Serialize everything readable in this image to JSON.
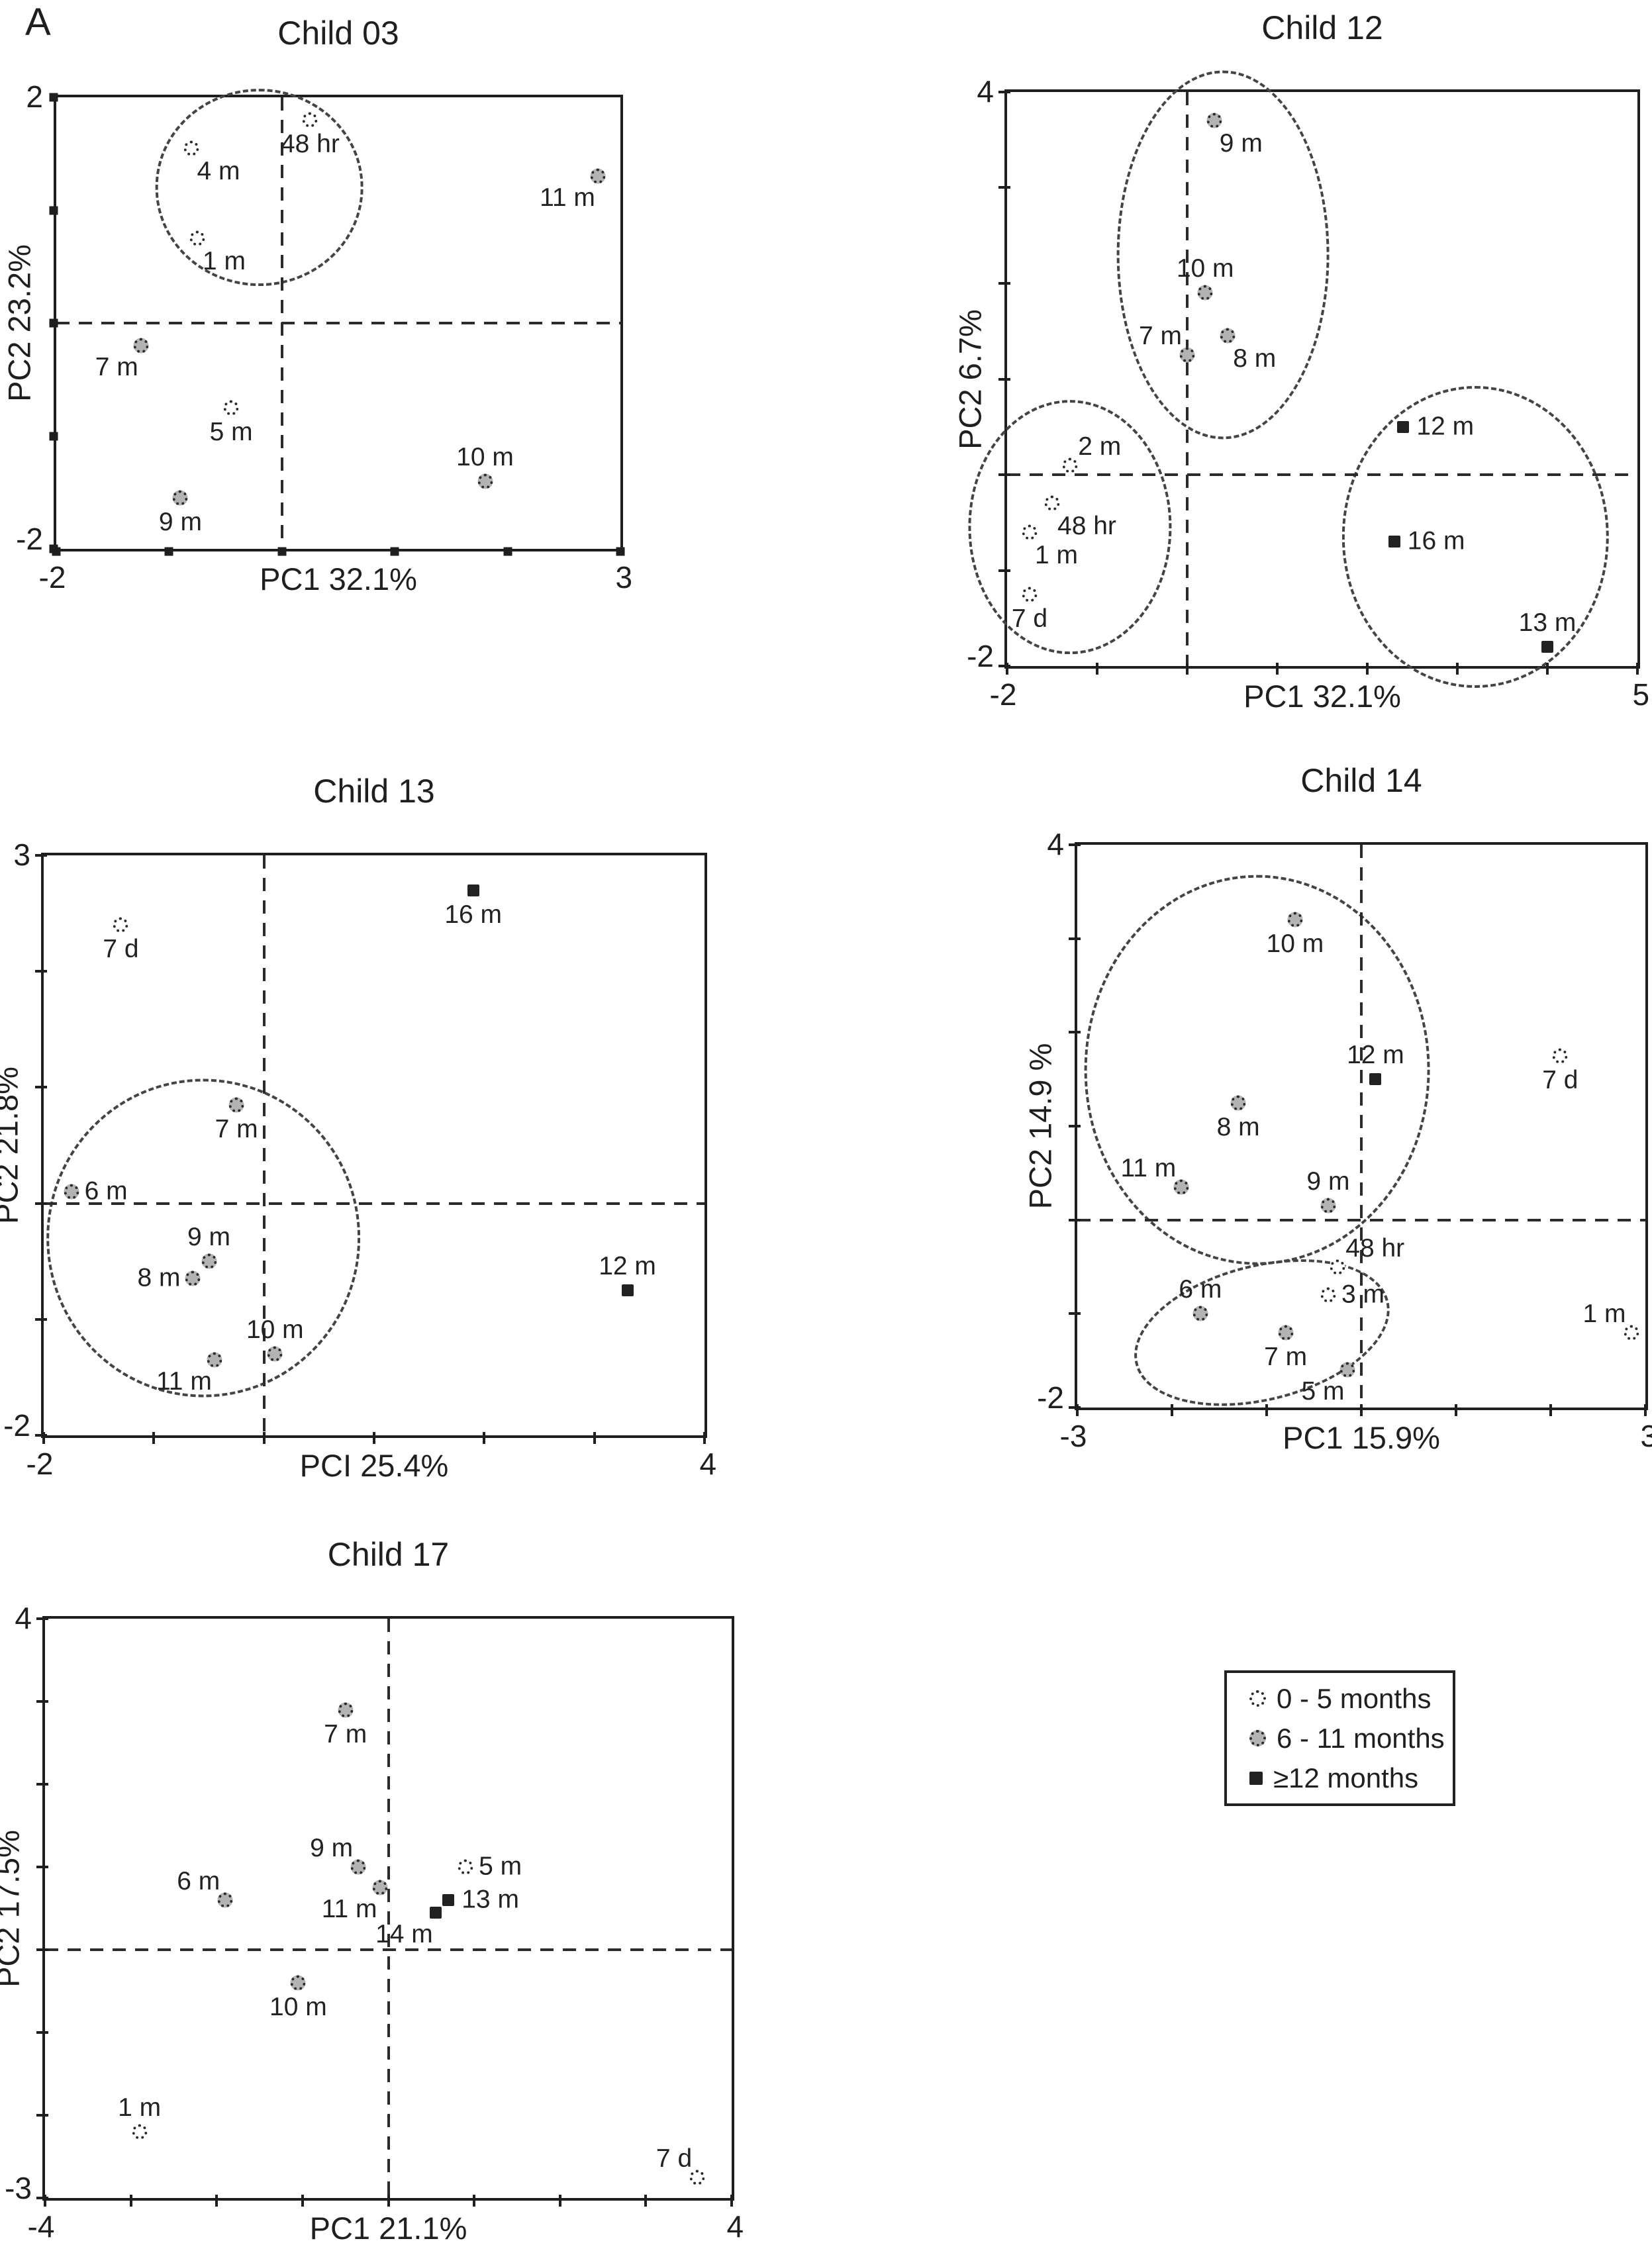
{
  "figure": {
    "panel_label": "A"
  },
  "legend": {
    "items": [
      {
        "marker": "open",
        "label": "0 - 5 months"
      },
      {
        "marker": "gray",
        "label": "6 - 11 months"
      },
      {
        "marker": "square",
        "label": "≥12 months"
      }
    ]
  },
  "chart_data": [
    {
      "type": "scatter",
      "title": "Child 03",
      "xlabel": "PC1 32.1%",
      "ylabel": "PC2 23.2%",
      "xlim": [
        -2,
        3
      ],
      "ylim": [
        -2,
        2
      ],
      "xticks": {
        "left": "-2",
        "right": "3"
      },
      "yticks": {
        "top": "2",
        "bottom": "-2"
      },
      "crosshair": {
        "x": 0,
        "y": 0
      },
      "tick_style": "square",
      "grid": false,
      "points": [
        {
          "label": "48 hr",
          "marker": "open",
          "x": 0.25,
          "y": 1.8,
          "label_pos": "below"
        },
        {
          "label": "4 m",
          "marker": "open",
          "x": -0.8,
          "y": 1.55,
          "label_pos": "below-right"
        },
        {
          "label": "1 m",
          "marker": "open",
          "x": -0.75,
          "y": 0.75,
          "label_pos": "below-right"
        },
        {
          "label": "11 m",
          "marker": "gray",
          "x": 2.8,
          "y": 1.3,
          "label_pos": "below-left"
        },
        {
          "label": "7 m",
          "marker": "gray",
          "x": -1.25,
          "y": -0.2,
          "label_pos": "below-left"
        },
        {
          "label": "5 m",
          "marker": "open",
          "x": -0.45,
          "y": -0.75,
          "label_pos": "below"
        },
        {
          "label": "9 m",
          "marker": "gray",
          "x": -0.9,
          "y": -1.55,
          "label_pos": "below"
        },
        {
          "label": "10 m",
          "marker": "gray",
          "x": 1.8,
          "y": -1.4,
          "label_pos": "above"
        }
      ],
      "ellipses": [
        {
          "cx": -0.2,
          "cy": 1.2,
          "rx": 0.9,
          "ry": 0.85,
          "rotate": 0
        }
      ]
    },
    {
      "type": "scatter",
      "title": "Child 12",
      "xlabel": "PC1 32.1%",
      "ylabel": "PC2 6.7%",
      "xlim": [
        -2,
        5
      ],
      "ylim": [
        -2,
        4
      ],
      "xticks": {
        "left": "-2",
        "right": "5"
      },
      "yticks": {
        "top": "4",
        "bottom": "-2"
      },
      "crosshair": {
        "x": 0,
        "y": 0
      },
      "tick_style": "line",
      "grid": false,
      "points": [
        {
          "label": "9 m",
          "marker": "gray",
          "x": 0.3,
          "y": 3.7,
          "label_pos": "below-right"
        },
        {
          "label": "10 m",
          "marker": "gray",
          "x": 0.2,
          "y": 1.9,
          "label_pos": "above"
        },
        {
          "label": "8 m",
          "marker": "gray",
          "x": 0.45,
          "y": 1.45,
          "label_pos": "below-right"
        },
        {
          "label": "7 m",
          "marker": "gray",
          "x": 0.0,
          "y": 1.25,
          "label_pos": "above-left"
        },
        {
          "label": "2 m",
          "marker": "open",
          "x": -1.3,
          "y": 0.1,
          "label_pos": "above-right"
        },
        {
          "label": "48 hr",
          "marker": "open",
          "x": -1.5,
          "y": -0.3,
          "label_pos": "below-right"
        },
        {
          "label": "1 m",
          "marker": "open",
          "x": -1.75,
          "y": -0.6,
          "label_pos": "below-right"
        },
        {
          "label": "7 d",
          "marker": "open",
          "x": -1.75,
          "y": -1.25,
          "label_pos": "below"
        },
        {
          "label": "12 m",
          "marker": "square",
          "x": 2.4,
          "y": 0.5,
          "label_pos": "right"
        },
        {
          "label": "16 m",
          "marker": "square",
          "x": 2.3,
          "y": -0.7,
          "label_pos": "right"
        },
        {
          "label": "13 m",
          "marker": "square",
          "x": 4.0,
          "y": -1.8,
          "label_pos": "above"
        }
      ],
      "ellipses": [
        {
          "cx": 0.4,
          "cy": 2.3,
          "rx": 1.15,
          "ry": 1.9,
          "rotate": 0
        },
        {
          "cx": -1.3,
          "cy": -0.55,
          "rx": 1.1,
          "ry": 1.3,
          "rotate": 0
        },
        {
          "cx": 3.2,
          "cy": -0.65,
          "rx": 1.45,
          "ry": 1.55,
          "rotate": 0
        }
      ]
    },
    {
      "type": "scatter",
      "title": "Child 13",
      "xlabel": "PCI 25.4%",
      "ylabel": "PC2 21.8%",
      "xlim": [
        -2,
        4
      ],
      "ylim": [
        -2,
        3
      ],
      "xticks": {
        "left": "-2",
        "right": "4"
      },
      "yticks": {
        "top": "3",
        "bottom": "-2"
      },
      "crosshair": {
        "x": 0,
        "y": 0
      },
      "tick_style": "line",
      "grid": false,
      "points": [
        {
          "label": "7 d",
          "marker": "open",
          "x": -1.3,
          "y": 2.4,
          "label_pos": "below"
        },
        {
          "label": "16 m",
          "marker": "square",
          "x": 1.9,
          "y": 2.7,
          "label_pos": "below"
        },
        {
          "label": "7 m",
          "marker": "gray",
          "x": -0.25,
          "y": 0.85,
          "label_pos": "below"
        },
        {
          "label": "6 m",
          "marker": "gray",
          "x": -1.75,
          "y": 0.1,
          "label_pos": "right"
        },
        {
          "label": "9 m",
          "marker": "gray",
          "x": -0.5,
          "y": -0.5,
          "label_pos": "above"
        },
        {
          "label": "8 m",
          "marker": "gray",
          "x": -0.65,
          "y": -0.65,
          "label_pos": "left"
        },
        {
          "label": "12 m",
          "marker": "square",
          "x": 3.3,
          "y": -0.75,
          "label_pos": "above"
        },
        {
          "label": "10 m",
          "marker": "gray",
          "x": 0.1,
          "y": -1.3,
          "label_pos": "above"
        },
        {
          "label": "11 m",
          "marker": "gray",
          "x": -0.45,
          "y": -1.35,
          "label_pos": "below-left"
        }
      ],
      "ellipses": [
        {
          "cx": -0.55,
          "cy": -0.3,
          "rx": 1.4,
          "ry": 1.35,
          "rotate": 0
        }
      ]
    },
    {
      "type": "scatter",
      "title": "Child 14",
      "xlabel": "PC1 15.9%",
      "ylabel": "PC2 14.9 %",
      "xlim": [
        -3,
        3
      ],
      "ylim": [
        -2,
        4
      ],
      "xticks": {
        "left": "-3",
        "right": "3"
      },
      "yticks": {
        "top": "4",
        "bottom": "-2"
      },
      "crosshair": {
        "x": 0,
        "y": 0
      },
      "tick_style": "line",
      "grid": false,
      "points": [
        {
          "label": "10 m",
          "marker": "gray",
          "x": -0.7,
          "y": 3.2,
          "label_pos": "below"
        },
        {
          "label": "12 m",
          "marker": "square",
          "x": 0.15,
          "y": 1.5,
          "label_pos": "above"
        },
        {
          "label": "7 d",
          "marker": "open",
          "x": 2.1,
          "y": 1.75,
          "label_pos": "below"
        },
        {
          "label": "8 m",
          "marker": "gray",
          "x": -1.3,
          "y": 1.25,
          "label_pos": "below"
        },
        {
          "label": "11 m",
          "marker": "gray",
          "x": -1.9,
          "y": 0.35,
          "label_pos": "above-left"
        },
        {
          "label": "9 m",
          "marker": "gray",
          "x": -0.35,
          "y": 0.15,
          "label_pos": "above"
        },
        {
          "label": "48 hr",
          "marker": "open",
          "x": -0.25,
          "y": -0.5,
          "label_pos": "above-right"
        },
        {
          "label": "3 m",
          "marker": "open",
          "x": -0.35,
          "y": -0.8,
          "label_pos": "right"
        },
        {
          "label": "6 m",
          "marker": "gray",
          "x": -1.7,
          "y": -1.0,
          "label_pos": "above"
        },
        {
          "label": "7 m",
          "marker": "gray",
          "x": -0.8,
          "y": -1.2,
          "label_pos": "below"
        },
        {
          "label": "5 m",
          "marker": "gray",
          "x": -0.15,
          "y": -1.6,
          "label_pos": "below-left"
        },
        {
          "label": "1 m",
          "marker": "open",
          "x": 2.85,
          "y": -1.2,
          "label_pos": "above-left"
        }
      ],
      "ellipses": [
        {
          "cx": -1.1,
          "cy": 1.6,
          "rx": 1.8,
          "ry": 2.05,
          "rotate": 0
        },
        {
          "cx": -1.05,
          "cy": -1.2,
          "rx": 1.35,
          "ry": 0.7,
          "rotate": -14
        }
      ]
    },
    {
      "type": "scatter",
      "title": "Child 17",
      "xlabel": "PC1 21.1%",
      "ylabel": "PC2 17.5%",
      "xlim": [
        -4,
        4
      ],
      "ylim": [
        -3,
        4
      ],
      "xticks": {
        "left": "-4",
        "right": "4"
      },
      "yticks": {
        "top": "4",
        "bottom": "-3"
      },
      "crosshair": {
        "x": 0,
        "y": 0
      },
      "tick_style": "line",
      "grid": false,
      "points": [
        {
          "label": "7 m",
          "marker": "gray",
          "x": -0.5,
          "y": 2.9,
          "label_pos": "below"
        },
        {
          "label": "9 m",
          "marker": "gray",
          "x": -0.35,
          "y": 1.0,
          "label_pos": "above-left"
        },
        {
          "label": "5 m",
          "marker": "open",
          "x": 0.9,
          "y": 1.0,
          "label_pos": "right"
        },
        {
          "label": "11 m",
          "marker": "gray",
          "x": -0.1,
          "y": 0.75,
          "label_pos": "below-left"
        },
        {
          "label": "13 m",
          "marker": "square",
          "x": 0.7,
          "y": 0.6,
          "label_pos": "right"
        },
        {
          "label": "14 m",
          "marker": "square",
          "x": 0.55,
          "y": 0.45,
          "label_pos": "below-left"
        },
        {
          "label": "6 m",
          "marker": "gray",
          "x": -1.9,
          "y": 0.6,
          "label_pos": "above-left"
        },
        {
          "label": "10 m",
          "marker": "gray",
          "x": -1.05,
          "y": -0.4,
          "label_pos": "below"
        },
        {
          "label": "1 m",
          "marker": "open",
          "x": -2.9,
          "y": -2.2,
          "label_pos": "above"
        },
        {
          "label": "7 d",
          "marker": "open",
          "x": 3.6,
          "y": -2.75,
          "label_pos": "above-left"
        }
      ],
      "ellipses": []
    }
  ]
}
